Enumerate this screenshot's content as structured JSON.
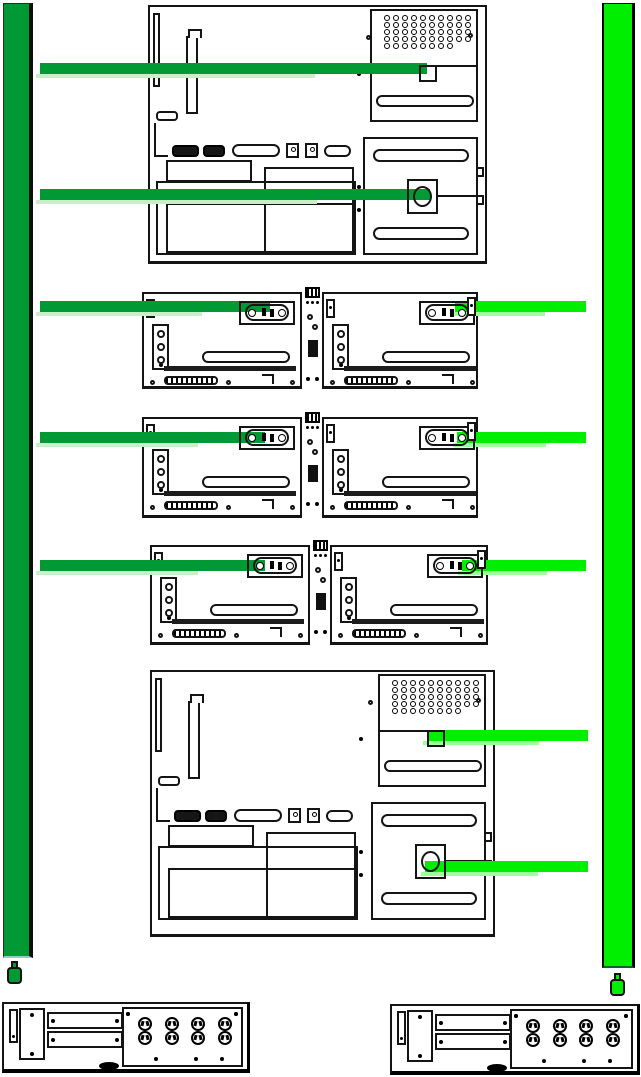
{
  "colors": {
    "feed_a": "#009934",
    "feed_a_fringe": "#c9eec9",
    "feed_b": "#00ef00",
    "feed_b_fringe": "#9dff9d",
    "ink": "#141414"
  },
  "power_strips": [
    {
      "id": "A",
      "side": "left",
      "style": "dark-green-vertical-bar",
      "plug": "power-plug-glyph-below"
    },
    {
      "id": "B",
      "side": "right",
      "style": "bright-green-vertical-bar",
      "plug": "power-plug-glyph-below"
    }
  ],
  "big_server": {
    "pci_slots": 8,
    "fan_grille": {
      "rows": 6,
      "cols": 8
    },
    "power_supplies": 2,
    "io_ports": 6
  },
  "dual_node_rows": 3,
  "outlet_panel": {
    "outlets": {
      "rows": 2,
      "cols": 4
    },
    "outlet_col_x": [
      14,
      41,
      67,
      94
    ],
    "outlet_row_y": [
      8,
      22
    ],
    "screw_dot_x": [
      30,
      70,
      96
    ],
    "screw_dot_y": 48
  },
  "cables": [
    {
      "id": "a-top-server-psu1",
      "feed": "A",
      "from": "power-strip-a",
      "to": "top-server-psu1-inlet",
      "x": 40,
      "y": 63,
      "len": 387
    },
    {
      "id": "a-top-server-psu2",
      "feed": "A",
      "from": "power-strip-a",
      "to": "top-server-psu2-inlet",
      "x": 40,
      "y": 189,
      "len": 390
    },
    {
      "id": "a-row1-left-node",
      "feed": "A",
      "from": "power-strip-a",
      "to": "row1-left-node-inlet",
      "x": 40,
      "y": 301,
      "len": 230
    },
    {
      "id": "b-row1-right-node",
      "feed": "B",
      "from": "power-strip-b",
      "to": "row1-right-node-inlet",
      "x": 455,
      "y": 301,
      "len": 131
    },
    {
      "id": "a-row2-left-node",
      "feed": "A",
      "from": "power-strip-a",
      "to": "row2-left-node-inlet",
      "x": 40,
      "y": 432,
      "len": 225
    },
    {
      "id": "b-row2-right-node",
      "feed": "B",
      "from": "power-strip-b",
      "to": "row2-right-node-inlet",
      "x": 457,
      "y": 432,
      "len": 129
    },
    {
      "id": "a-row3-left-node",
      "feed": "A",
      "from": "power-strip-a",
      "to": "row3-left-node-inlet",
      "x": 40,
      "y": 560,
      "len": 225
    },
    {
      "id": "b-row3-right-node",
      "feed": "B",
      "from": "power-strip-b",
      "to": "row3-right-node-inlet",
      "x": 462,
      "y": 560,
      "len": 124
    },
    {
      "id": "b-bottom-server-psu1",
      "feed": "B",
      "from": "power-strip-b",
      "to": "bottom-server-psu1-inlet",
      "x": 427,
      "y": 730,
      "len": 161
    },
    {
      "id": "b-bottom-server-psu2",
      "feed": "B",
      "from": "power-strip-b",
      "to": "bottom-server-psu2-inlet",
      "x": 425,
      "y": 861,
      "len": 163
    }
  ]
}
